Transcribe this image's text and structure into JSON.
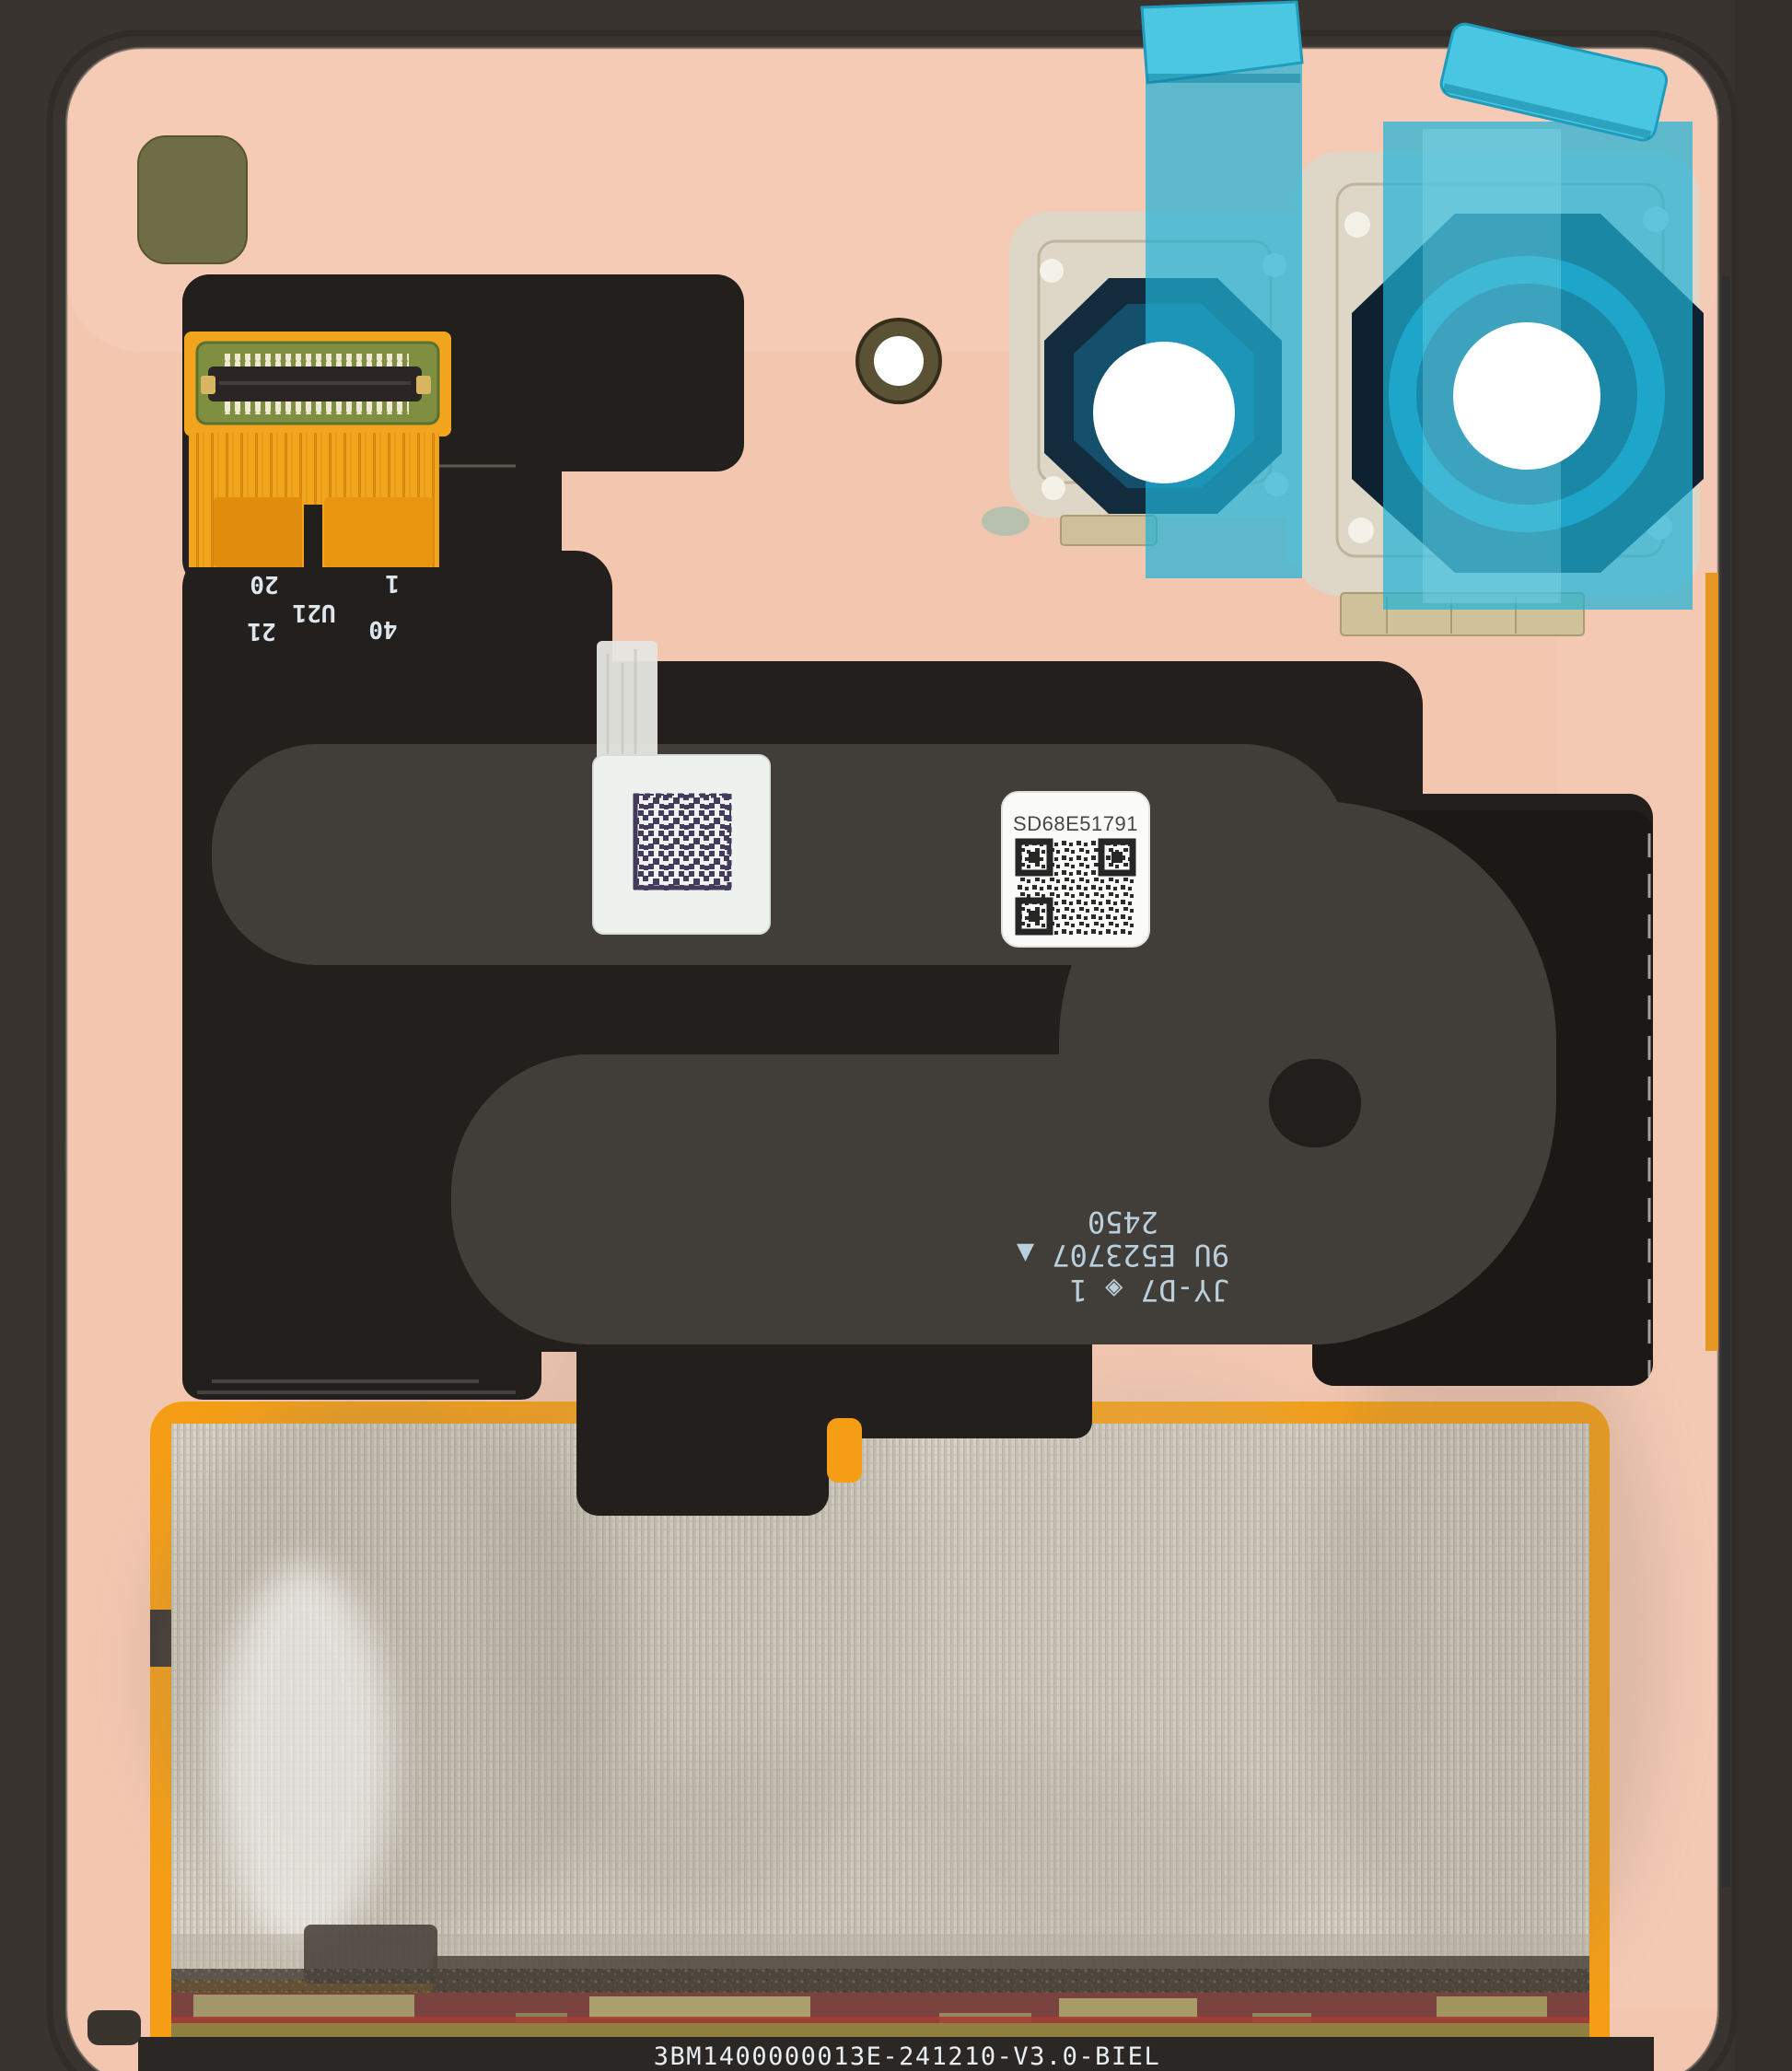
{
  "connector": {
    "pin1": "1",
    "pin40": "40",
    "pin20": "20",
    "designator": "U21",
    "pin21": "21"
  },
  "labels": {
    "serial": "SD68E51791"
  },
  "markings": {
    "line1": "JY-D7 ◈ 1",
    "line2": "9U E523707 ▲",
    "line3": "2450"
  },
  "footer": {
    "part_code": "3BM1400000013E-241210-V3.0-BIEL"
  },
  "colors": {
    "frame": "#39342f",
    "panel": "#f3c6b0",
    "film_blue": "#29b6d8",
    "flex_dark": "#231f1c",
    "flex_ribbon": "#413d39",
    "foil_border": "#f59e15",
    "mesh_silver": "#cdc6ba",
    "pad_olive": "#6f6d46",
    "gold_flex": "#f2a41e"
  }
}
